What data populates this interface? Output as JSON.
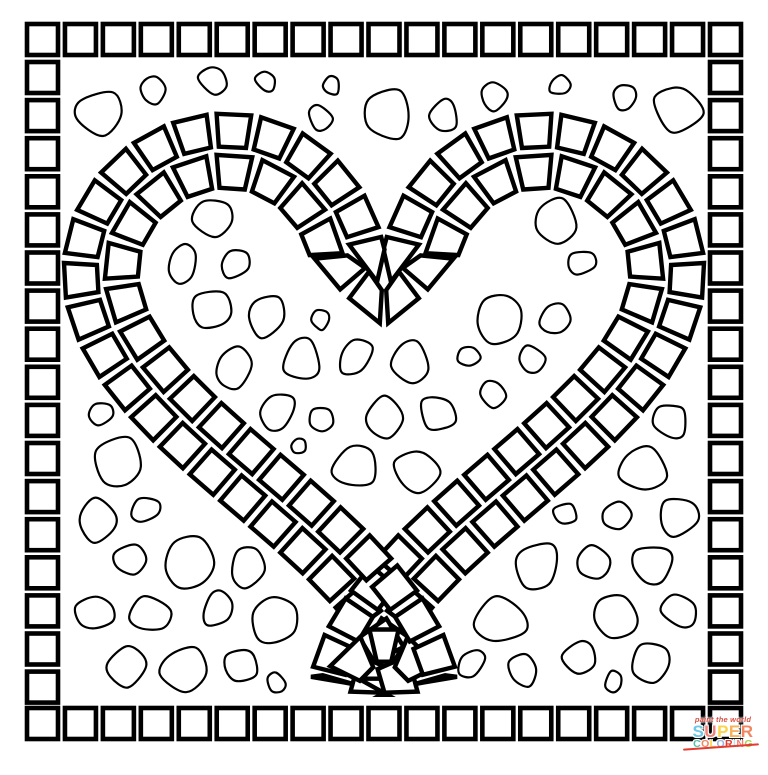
{
  "palette": {
    "ink": "#000000",
    "paper": "#ffffff"
  },
  "figure": {
    "canvas": {
      "width": 768,
      "height": 775
    },
    "border": {
      "margin": 27,
      "square": 31,
      "stroke": 4.6,
      "top_count": 19,
      "bottom_count": 19,
      "side_count": 17,
      "top_y": 24,
      "bottom_y": 708,
      "side_y0": 62,
      "side_pitch": 38.1
    },
    "heart": {
      "center_x": 384,
      "y_offset": 352,
      "scale": 20.05,
      "samples": 1440,
      "tile_half_depth": 16.5,
      "tile_pad": 4.5,
      "tile_stroke": 4.4,
      "rows": [
        {
          "name": "outer-ring",
          "depth": 17,
          "pitch": 40
        },
        {
          "name": "inner-ring",
          "depth": 58,
          "pitch": 40
        }
      ]
    },
    "pebbles": {
      "seed": 11,
      "stroke": 2.2,
      "grid_pitch_x": 58,
      "grid_pitch_y": 50,
      "jitter": 8,
      "gap": 7,
      "inner_clearance": 80,
      "outer_clearance": 6,
      "frame_left": 62,
      "frame_right": 706,
      "frame_top": 60,
      "frame_bottom": 703,
      "passes": [
        {
          "rmin": 13,
          "rbase": 24,
          "rvar": 8
        },
        {
          "rmin": 9,
          "rbase": 13,
          "rvar": 5
        }
      ]
    }
  },
  "logo": {
    "tagline": "paint the world",
    "tagline_color": "#d94f43",
    "title": "SUPER",
    "subtitle": "COLORING",
    "underline_color": "#e23b30",
    "super_letters": [
      {
        "ch": "S",
        "color": "#6fc7e7"
      },
      {
        "ch": "U",
        "color": "#f2837b"
      },
      {
        "ch": "P",
        "color": "#fcd34d"
      },
      {
        "ch": "E",
        "color": "#f8b25c"
      },
      {
        "ch": "R",
        "color": "#f3865f"
      }
    ],
    "coloring_letters": [
      {
        "ch": "C",
        "color": "#57bfa8"
      },
      {
        "ch": "O",
        "color": "#f3865f"
      },
      {
        "ch": "L",
        "color": "#fcd34d"
      },
      {
        "ch": "O",
        "color": "#9fb3da"
      },
      {
        "ch": "R",
        "color": "#e23b30"
      },
      {
        "ch": "I",
        "color": "#bde0ea"
      },
      {
        "ch": "N",
        "color": "#f2837b"
      },
      {
        "ch": "G",
        "color": "#a9cf54"
      }
    ]
  }
}
